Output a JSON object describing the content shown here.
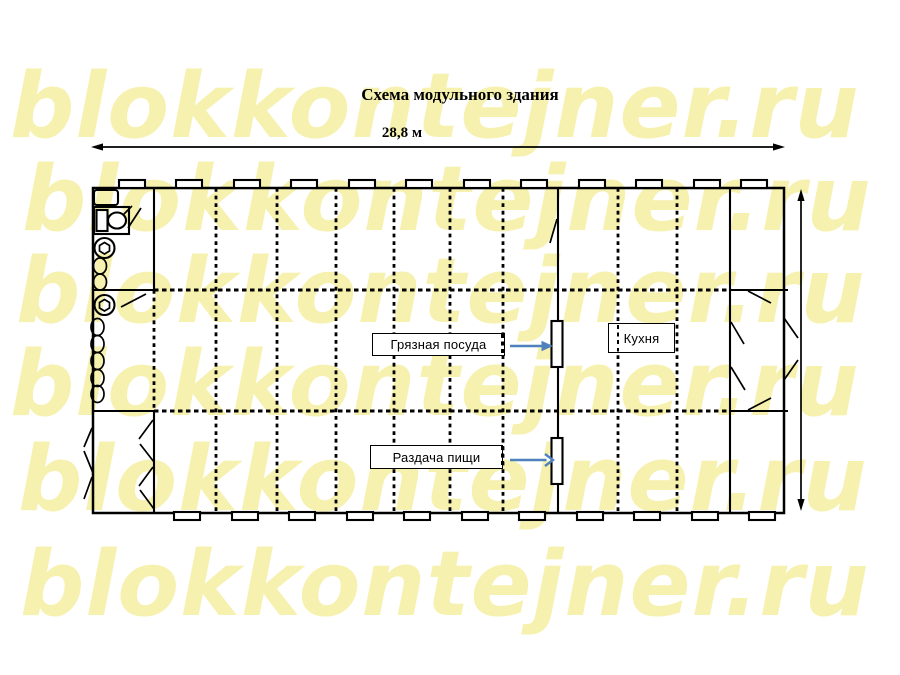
{
  "watermark": {
    "text": "blokkontejner.ru"
  },
  "title": "Схема модульного здания",
  "dimensions": {
    "width_label": "28,8 м"
  },
  "room_labels": {
    "dirty_dishes": "Грязная посуда",
    "food_serving": "Раздача пищи",
    "kitchen": "Кухня"
  },
  "colors": {
    "line": "#000000",
    "callout_arrow": "#4f81bd",
    "watermark": "#f6f1ae",
    "background": "#ffffff"
  }
}
